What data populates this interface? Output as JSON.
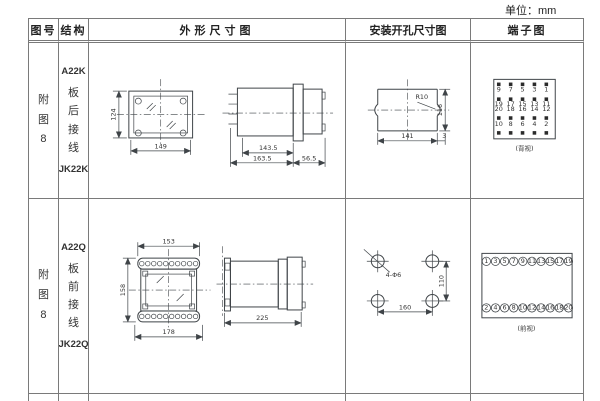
{
  "unit_label": "单位：mm",
  "colors": {
    "ink": "#3f4448",
    "table_border": "#7a7a7a",
    "text": "#333333",
    "terminal_dot": "#2b2b2b"
  },
  "table": {
    "headers": [
      "图号",
      "结构",
      "外形尺寸图",
      "安装开孔尺寸图",
      "端子图"
    ],
    "rows": [
      {
        "fig_no": "附图8",
        "model_top": "A22K",
        "wiring": "板后接线",
        "model_bottom": "JK22K",
        "outline": {
          "height": "124",
          "width": "149",
          "body_depth": "143.5",
          "total_depth": "163.5",
          "rear_depth": "56.5"
        },
        "mounting": {
          "radius": "R10",
          "width": "141",
          "height": "116",
          "edge": "3"
        },
        "terminal": {
          "caption": "(背视)",
          "grid": [
            [
              "9",
              "7",
              "5",
              "3",
              "1"
            ],
            [
              "19",
              "17",
              "15",
              "13",
              "11"
            ],
            [
              "20",
              "18",
              "16",
              "14",
              "12"
            ],
            [
              "10",
              "8",
              "6",
              "4",
              "2"
            ]
          ]
        }
      },
      {
        "fig_no": "附图8",
        "model_top": "A22Q",
        "wiring": "板前接线",
        "model_bottom": "JK22Q",
        "outline": {
          "top_width": "153",
          "height": "158",
          "bottom_width": "178",
          "depth": "225"
        },
        "mounting": {
          "hole_label": "4-Φ6",
          "width": "160",
          "height": "110"
        },
        "terminal": {
          "caption": "(前视)",
          "top_row": [
            "1",
            "3",
            "5",
            "7",
            "9",
            "11",
            "13",
            "15",
            "17",
            "19"
          ],
          "bottom_row": [
            "2",
            "4",
            "6",
            "8",
            "10",
            "12",
            "14",
            "16",
            "18",
            "20"
          ]
        }
      }
    ]
  }
}
